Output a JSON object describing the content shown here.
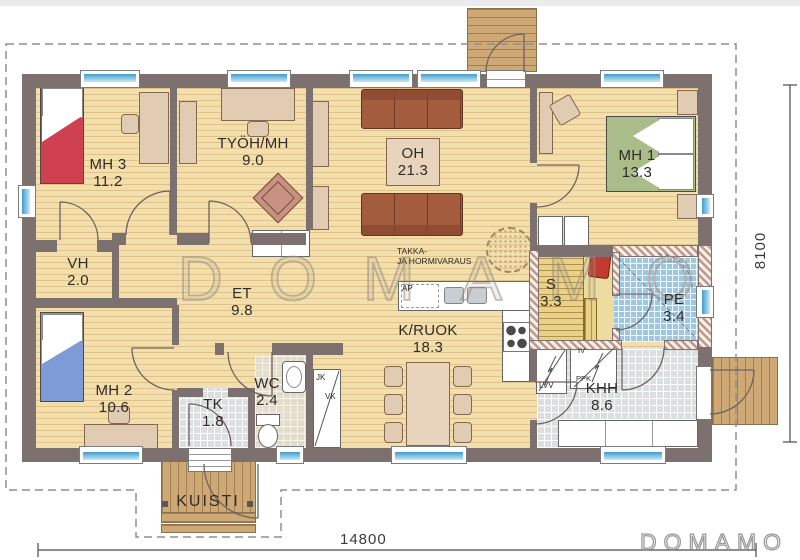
{
  "plan": {
    "title": "house floor plan",
    "watermark": {
      "center": "DOMAMO",
      "corner": "DOMAMO"
    },
    "dimensions": {
      "width": "14800",
      "height": "8100"
    },
    "rooms": [
      {
        "label": "MH 3",
        "area": "11.2"
      },
      {
        "label": "TYÖH/MH",
        "area": "9.0"
      },
      {
        "label": "OH",
        "area": "21.3"
      },
      {
        "label": "MH 1",
        "area": "13.3"
      },
      {
        "label": "VH",
        "area": "2.0"
      },
      {
        "label": "ET",
        "area": "9.8"
      },
      {
        "label": "MH 2",
        "area": "10.6"
      },
      {
        "label": "TK",
        "area": "1.8"
      },
      {
        "label": "WC",
        "area": "2.4"
      },
      {
        "label": "K/RUOK",
        "area": "18.3"
      },
      {
        "label": "S",
        "area": "3.3"
      },
      {
        "label": "PE",
        "area": "3.4"
      },
      {
        "label": "KHH",
        "area": "8.6"
      },
      {
        "label": "KUISTI",
        "area": ""
      }
    ],
    "annotations": {
      "fireplace1": "TAKKA-",
      "fireplace2": "JA HORMIVARAUS",
      "ap": "AP",
      "jk": "JK",
      "vk": "VK",
      "lvv": "LVV",
      "iv": "IV",
      "ppk": "PPK"
    },
    "colors": {
      "wall": "#7d7170",
      "floor": "#f3dfad",
      "glass": "#3f9ccc",
      "bed_red": "#cf4050",
      "bed_blue": "#7e9bd6",
      "bed_green": "#a9bc8a",
      "sofa": "#a35d3e",
      "deck": "#cfa975",
      "sauna_bench": "#e9d187",
      "tile_blue": "#9fc8e0",
      "tile_gray": "#dcdfe0",
      "sauna_stove": "#c23b2e"
    }
  }
}
